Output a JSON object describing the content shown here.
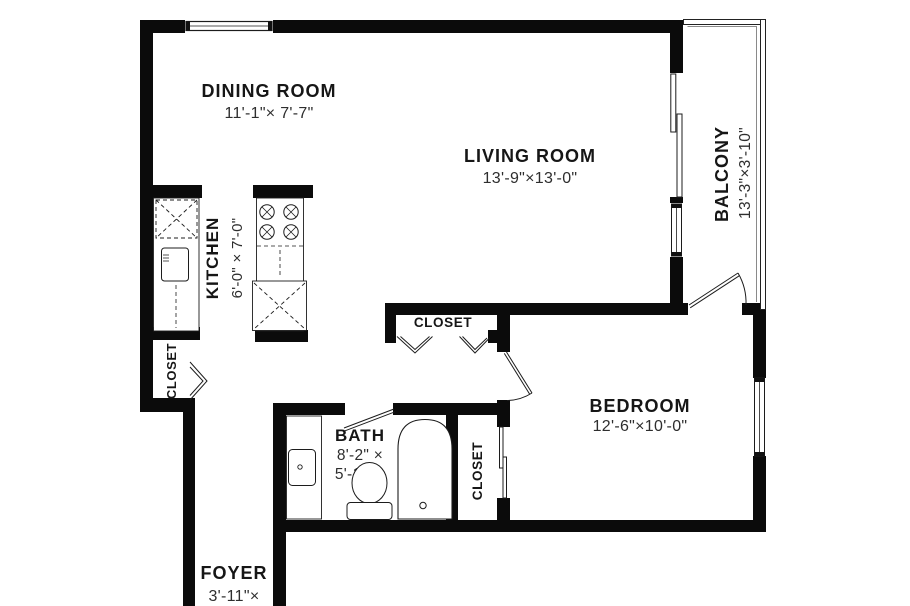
{
  "rooms": {
    "dining": {
      "name": "DINING ROOM",
      "dims": "11'-1\"× 7'-7\""
    },
    "living": {
      "name": "LIVING ROOM",
      "dims": "13'-9\"×13'-0\""
    },
    "balcony": {
      "name": "BALCONY",
      "dims": "13'-3\"×3'-10\""
    },
    "kitchen": {
      "name": "KITCHEN",
      "dims": "6'-0\" × 7'-0\""
    },
    "bedroom": {
      "name": "BEDROOM",
      "dims": "12'-6\"×10'-0\""
    },
    "bath": {
      "name": "BATH",
      "dims_line1": "8'-2\" ×",
      "dims_line2": "5'-1\""
    },
    "foyer": {
      "name": "FOYER",
      "dims": "3'-11\"×"
    },
    "closet_hall": {
      "name": "CLOSET"
    },
    "closet_middle": {
      "name": "CLOSET"
    },
    "closet_bedroom": {
      "name": "CLOSET"
    }
  },
  "colors": {
    "wall": "#0b0b0b",
    "line": "#1c1c1c",
    "background": "#ffffff",
    "text": "#161616",
    "dim_text": "#2e2e2e"
  }
}
